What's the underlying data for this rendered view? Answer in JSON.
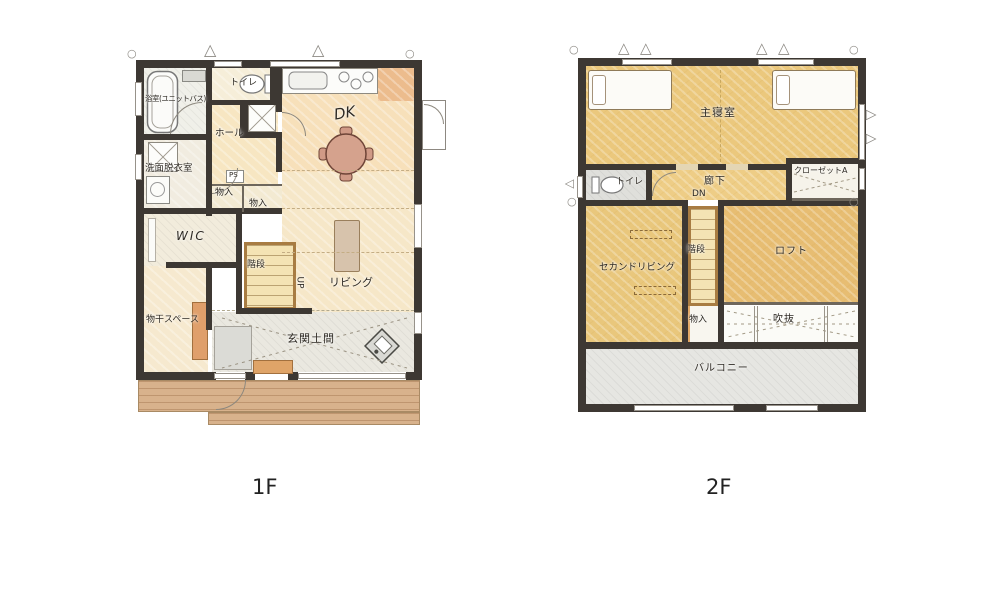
{
  "floor1": {
    "title": "1F",
    "rooms": {
      "bathroom": "浴室(ユニットバス)",
      "toilet": "トイレ",
      "hall": "ホール",
      "dk": "DK",
      "washroom": "洗面脱衣室",
      "ps": "PS",
      "storage_a": "物入",
      "storage_b": "物入",
      "wic": "WIC",
      "stairs": "階段",
      "up": "UP",
      "living": "リビング",
      "laundry": "物干スペース",
      "genkan": "玄関土間"
    }
  },
  "floor2": {
    "title": "2F",
    "rooms": {
      "master_bedroom": "主寝室",
      "toilet": "トイレ",
      "corridor": "廊下",
      "dn": "DN",
      "closet_a": "クローゼットA",
      "second_living": "セカンドリビング",
      "stairs": "階段",
      "loft": "ロフト",
      "storage": "物入",
      "void": "吹抜",
      "balcony": "バルコニー"
    }
  },
  "icons": {
    "window_triangle": "△",
    "corner_circle": "○"
  },
  "colors": {
    "wall": "#3d3833",
    "floor_cream": "#f7e0ba",
    "floor_gold": "#ebc87d",
    "floor_loft": "#e7bd72",
    "balcony_gray": "#e6e6e2",
    "genkan_gray": "#eae8e0",
    "deck_wood": "#d8b28c",
    "table_rose": "#d5a28d",
    "accent_orange": "#dfa468"
  }
}
